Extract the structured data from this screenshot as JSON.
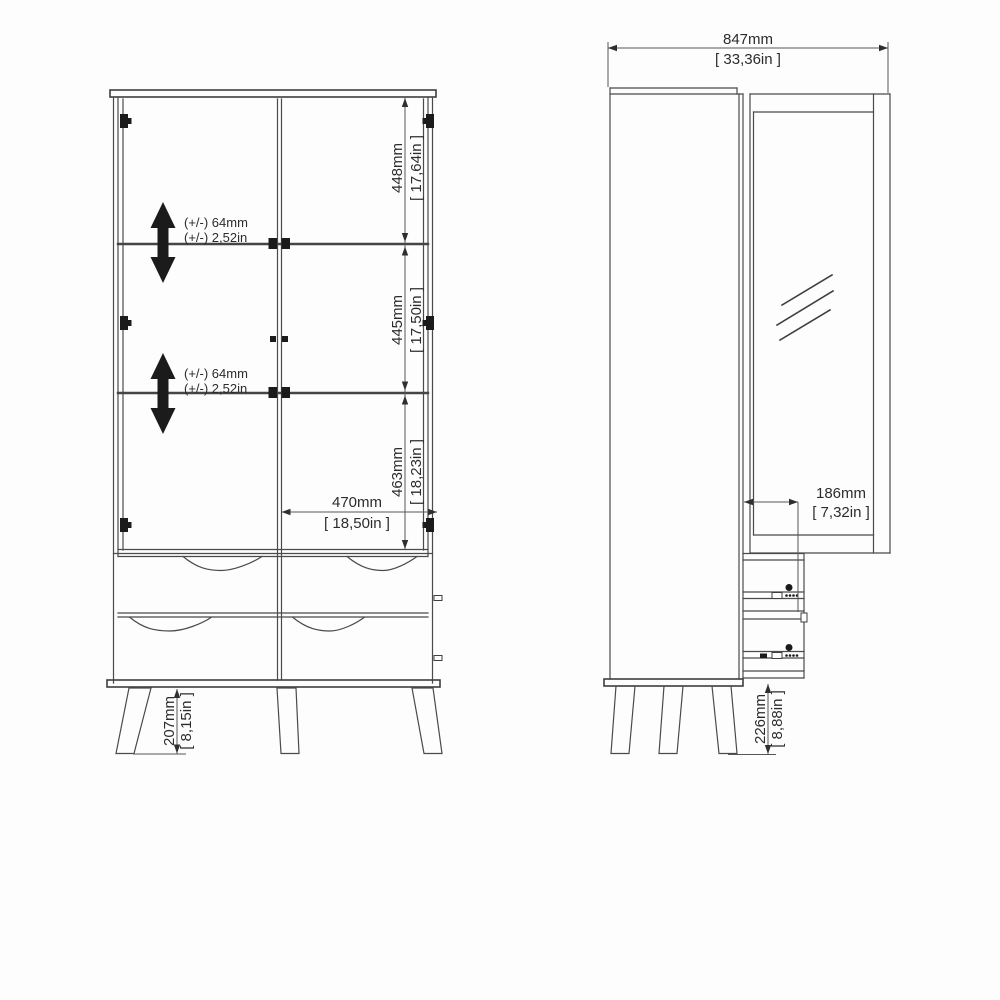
{
  "front_view": {
    "segment_dims": [
      {
        "mm": "448mm",
        "inch": "[ 17,64in ]"
      },
      {
        "mm": "445mm",
        "inch": "[ 17,50in ]"
      },
      {
        "mm": "463mm",
        "inch": "[ 18,23in ]"
      }
    ],
    "width_dim": {
      "mm": "470mm",
      "inch": "[ 18,50in ]"
    },
    "leg_dim": {
      "mm": "207mm",
      "inch": "[ 8,15in ]"
    },
    "shelf_adjust_upper": {
      "line1": "(+/-) 64mm",
      "line2": "(+/-) 2,52in"
    },
    "shelf_adjust_lower": {
      "line1": "(+/-) 64mm",
      "line2": "(+/-) 2,52in"
    }
  },
  "side_view": {
    "width_dim": {
      "mm": "847mm",
      "inch": "[ 33,36in ]"
    },
    "drawer_depth_dim": {
      "mm": "186mm",
      "inch": "[ 7,32in ]"
    },
    "leg_dim": {
      "mm": "226mm",
      "inch": "[ 8,88in ]"
    }
  },
  "icons": {
    "shelf_adjust": "double-vertical-arrow",
    "glass": "diagonal-reflection-hatch"
  },
  "colors": {
    "background": "#fdfdfd",
    "line": "#4a4a4a",
    "text": "#2c2c2c",
    "arrow_fill": "#1b1b1b"
  }
}
